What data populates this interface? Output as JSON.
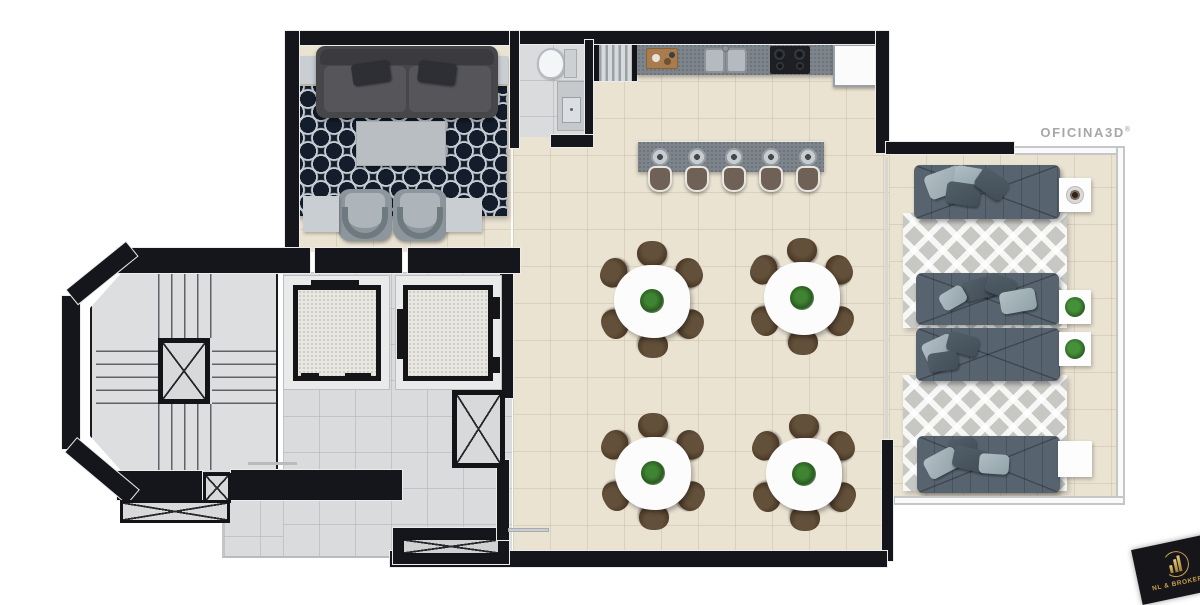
{
  "watermark": {
    "text": "OFICINA3D",
    "registered": "®",
    "color": "#a7a7a7"
  },
  "brand_logo": {
    "text": "NL & BROKERS",
    "icon": "buildings-icon",
    "background": "#15151a",
    "gold": "#c9a24d"
  },
  "plan": {
    "type": "furnished-floor-plan-render",
    "areas": {
      "living_room": {
        "furniture": [
          "sofa",
          "navy-lattice-rug",
          "coffee-table",
          "armchair",
          "armchair",
          "side-table",
          "side-table",
          "side-table",
          "side-table"
        ]
      },
      "bathroom": {
        "furniture": [
          "toilet",
          "sink-vanity"
        ]
      },
      "kitchen": {
        "furniture": [
          "wall-counter",
          "cutting-board",
          "double-sink",
          "cooktop",
          "refrigerator",
          "island-bar"
        ],
        "bar_stools": 5
      },
      "dining_area": {
        "tables": 4,
        "chairs_per_table": 6,
        "centerpiece": "plant"
      },
      "terrace_lounge": {
        "daybeds": 4,
        "chevron_rugs": 2,
        "side_tables": 4,
        "side_table_items": [
          "coffee-tray",
          "plant",
          "plant",
          "none"
        ]
      },
      "core": {
        "features": [
          "staircase",
          "elevator",
          "elevator",
          "service-shaft",
          "service-shaft",
          "service-shaft",
          "corridor"
        ]
      }
    },
    "palette": {
      "wall": "#15161b",
      "floor_beige": "#eae3d2",
      "floor_gray": "#d9dbdd",
      "rug_navy": "#131d2b",
      "rug_chevron": "#c7c7c3",
      "daybed": "#57636f",
      "dining_chair": "#4a3826",
      "plant": "#2f6d28",
      "counter": "#7d848b"
    }
  }
}
